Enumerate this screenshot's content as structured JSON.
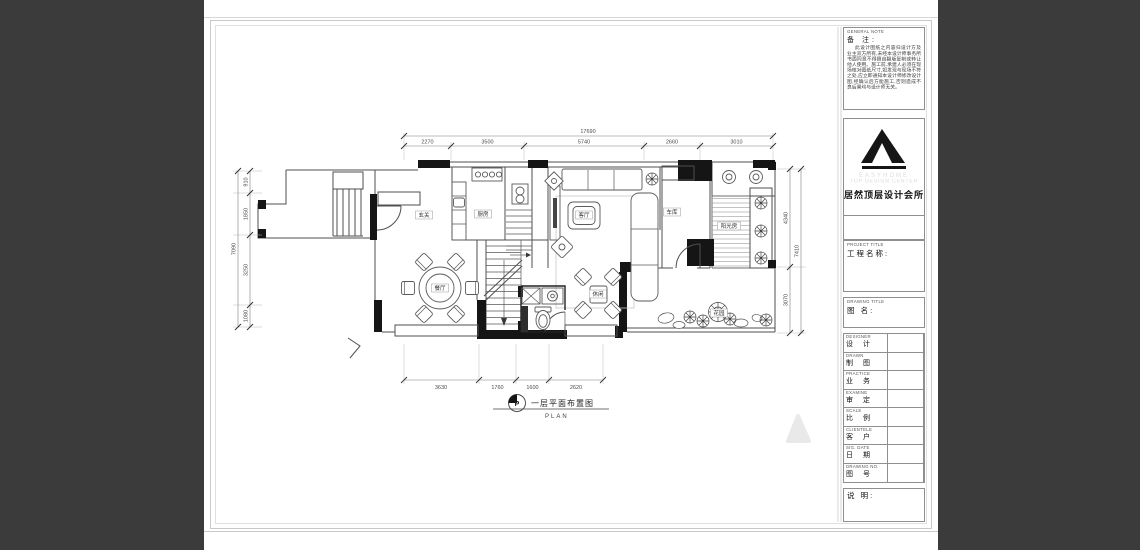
{
  "drawing": {
    "caption_cn": "一层平面布置图",
    "caption_en": "PLAN",
    "caption_symbol": "P"
  },
  "rooms": {
    "hall": "玄关",
    "kitchen": "厨房",
    "living": "客厅",
    "garage": "车库",
    "sunroom": "阳光房",
    "dining": "餐厅",
    "leisure": "休闲",
    "garden": "花园"
  },
  "dimensions": {
    "top_total": "17690",
    "top_segments": [
      "2270",
      "3500",
      "5740",
      "2660",
      "3010"
    ],
    "bottom_segments": [
      "3630",
      "1760",
      "1600",
      "2620"
    ],
    "left_total": "7090",
    "left_segments": [
      "910",
      "1850",
      "3250",
      "1080"
    ],
    "right_total": "7410",
    "right_segments": [
      "4340",
      "3070"
    ]
  },
  "title_block": {
    "general_note_en": "GENERAL NOTE",
    "general_note_cn": "备 注:",
    "note_body": "此设计图纸之内容归设计方及业主双方所有,未经本设计师事务所书面同意不得擅自翻版复制或转让他人使用。施工前,承建人必须在现场核对图纸尺寸,如发现与现场不符之处,应立即通知本设计师修改设计图,经确认后方能施工,否则造成不良后果均与设计师无关。",
    "brand_en_1": "EASYHOME",
    "brand_en_2": "TOP DESIGN CENTER",
    "brand_cn": "居然顶层设计会所",
    "project_title_en": "PROJECT TITLE",
    "project_title_cn": "工程名称:",
    "drawing_title_en": "DRAWING TITLE",
    "drawing_title_cn": "图  名:",
    "fields": [
      {
        "en": "DESIGNER",
        "cn": "设 计"
      },
      {
        "en": "DRAWN",
        "cn": "制 图"
      },
      {
        "en": "PRACTICE",
        "cn": "业 务"
      },
      {
        "en": "EXAMINE",
        "cn": "审 定"
      },
      {
        "en": "SCALE",
        "cn": "比 例"
      },
      {
        "en": "CLIENTELE",
        "cn": "客 户"
      },
      {
        "en": "SIG. DATE",
        "cn": "日 期"
      },
      {
        "en": "DRAWING NO.",
        "cn": "图 号"
      }
    ],
    "footer_cn": "说 明:"
  }
}
